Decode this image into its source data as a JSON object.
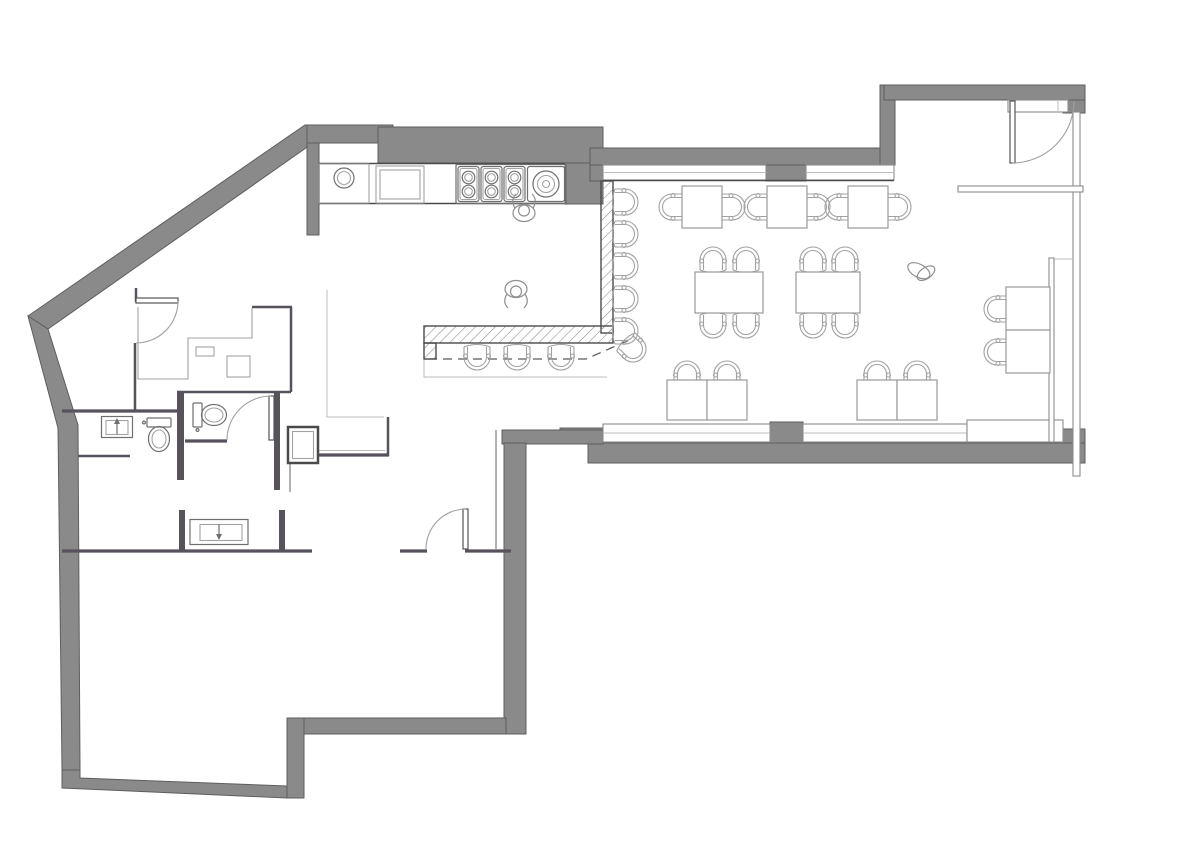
{
  "document": {
    "kind": "architectural-floor-plan",
    "background": "#ffffff"
  },
  "palette": {
    "wall_fill": "#8a8a8a",
    "wall_edge": "#5e5e5e",
    "interior_wall": "#57525c",
    "dark_line": "#4a4a4a",
    "medium_line": "#8f8f8f",
    "light_line": "#a2a2a2",
    "background": "#ffffff"
  },
  "rooms": [
    {
      "name": "kitchen"
    },
    {
      "name": "bar-counter"
    },
    {
      "name": "dining-area"
    },
    {
      "name": "entry-vestibule"
    },
    {
      "name": "restroom-1"
    },
    {
      "name": "restroom-2"
    },
    {
      "name": "back-office"
    },
    {
      "name": "service-corridor"
    },
    {
      "name": "lower-hall"
    }
  ],
  "inventory": {
    "dining_tables": 11,
    "dining_chairs": 20,
    "bar_stools": 9,
    "toilets": 2,
    "washbasins": 2,
    "cooktop_burner_modules": 3,
    "cooktop_burners_small": 6,
    "cooktop_burner_large": 1,
    "kitchen_sinks": 1,
    "staff_figures": 2,
    "plants": 1,
    "door_swings": 4
  },
  "floorplan": {
    "chairs_xyrot": [
      [
        672,
        207,
        -90
      ],
      [
        732,
        207,
        90
      ],
      [
        757,
        207,
        -90
      ],
      [
        817,
        207,
        90
      ],
      [
        838,
        207,
        -90
      ],
      [
        898,
        207,
        90
      ],
      [
        713,
        260,
        0
      ],
      [
        746,
        260,
        0
      ],
      [
        713,
        325,
        180
      ],
      [
        746,
        325,
        180
      ],
      [
        813,
        260,
        0
      ],
      [
        845,
        260,
        0
      ],
      [
        813,
        325,
        180
      ],
      [
        845,
        325,
        180
      ],
      [
        687,
        374,
        0
      ],
      [
        727,
        374,
        0
      ],
      [
        877,
        374,
        0
      ],
      [
        917,
        374,
        0
      ],
      [
        997,
        309,
        -90
      ],
      [
        997,
        352,
        -90
      ]
    ],
    "stools_xyrot": [
      [
        625,
        202,
        90
      ],
      [
        625,
        234,
        90
      ],
      [
        625,
        266,
        90
      ],
      [
        625,
        299,
        90
      ],
      [
        625,
        331,
        90
      ],
      [
        633,
        349,
        135
      ],
      [
        477,
        357,
        180
      ],
      [
        517,
        357,
        180
      ],
      [
        561,
        357,
        180
      ]
    ],
    "tables_xywh": [
      [
        682,
        186,
        40,
        42
      ],
      [
        767,
        186,
        40,
        42
      ],
      [
        848,
        186,
        40,
        42
      ],
      [
        695,
        272,
        68,
        41
      ],
      [
        796,
        272,
        64,
        41
      ],
      [
        667,
        380,
        40,
        40
      ],
      [
        707,
        380,
        40,
        40
      ],
      [
        857,
        380,
        40,
        40
      ],
      [
        897,
        380,
        40,
        40
      ],
      [
        1006,
        287,
        44,
        43
      ],
      [
        1006,
        330,
        44,
        43
      ]
    ],
    "fixtures": [
      {
        "type": "toilet",
        "x": 159,
        "y": 432,
        "rot": 0
      },
      {
        "type": "toilet",
        "x": 207,
        "y": 415,
        "rot": -90
      },
      {
        "type": "sink_small",
        "x": 117,
        "y": 427,
        "rot": 0
      },
      {
        "type": "sink_wide",
        "x": 219,
        "y": 532,
        "rot": 0
      },
      {
        "type": "chef",
        "x": 524,
        "y": 213,
        "rot": 0
      },
      {
        "type": "chef",
        "x": 516,
        "y": 289,
        "rot": 180
      },
      {
        "type": "plant",
        "x": 921,
        "y": 273,
        "rot": 0
      }
    ]
  }
}
